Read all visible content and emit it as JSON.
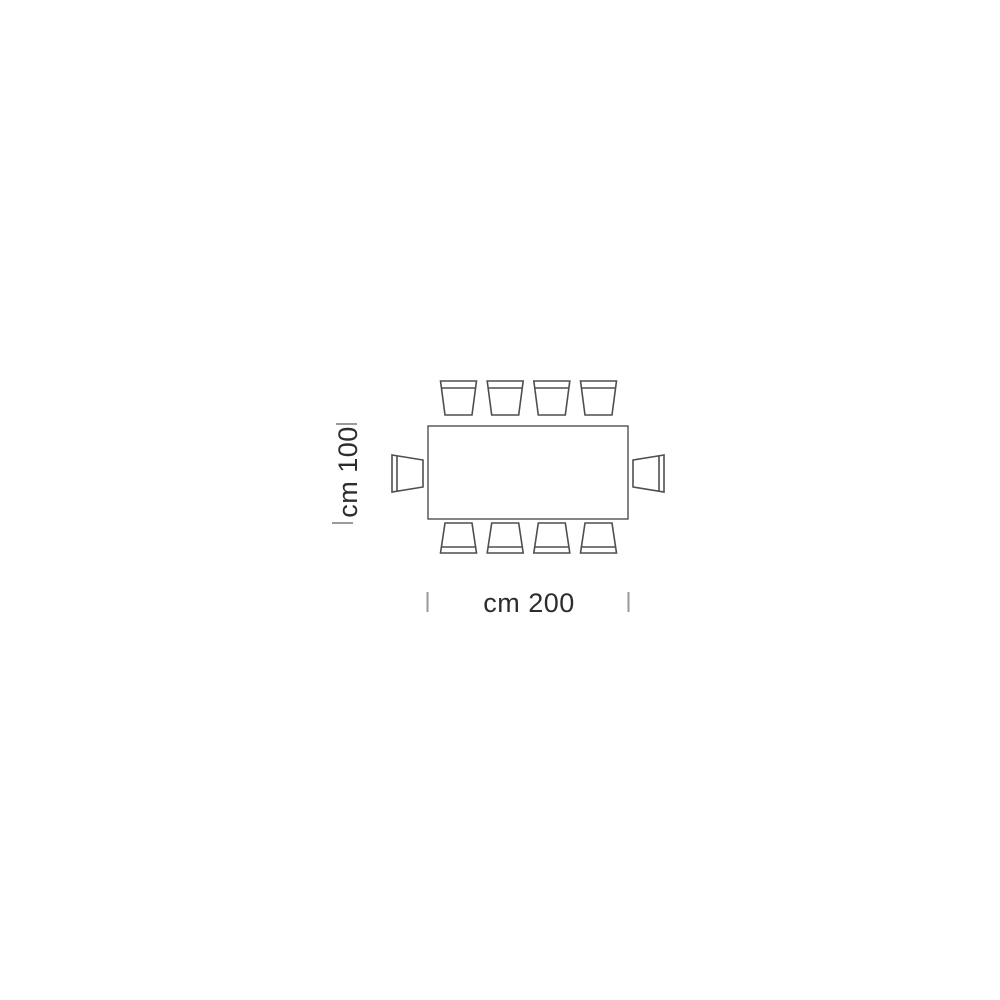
{
  "diagram": {
    "type": "furniture-plan-top-view",
    "subject": "rectangular table with ten chairs, plan view dimension drawing",
    "table": {
      "width_cm": 200,
      "depth_cm": 100
    },
    "labels": {
      "width": "cm 200",
      "height": "cm 100"
    },
    "seats": {
      "top": 4,
      "bottom": 4,
      "left": 1,
      "right": 1,
      "total": 10
    },
    "colors": {
      "outline": "#4f4f4f",
      "tick": "#9a9a9a",
      "text": "#2d2d2d",
      "background": "#ffffff",
      "fill": "#ffffff"
    }
  }
}
